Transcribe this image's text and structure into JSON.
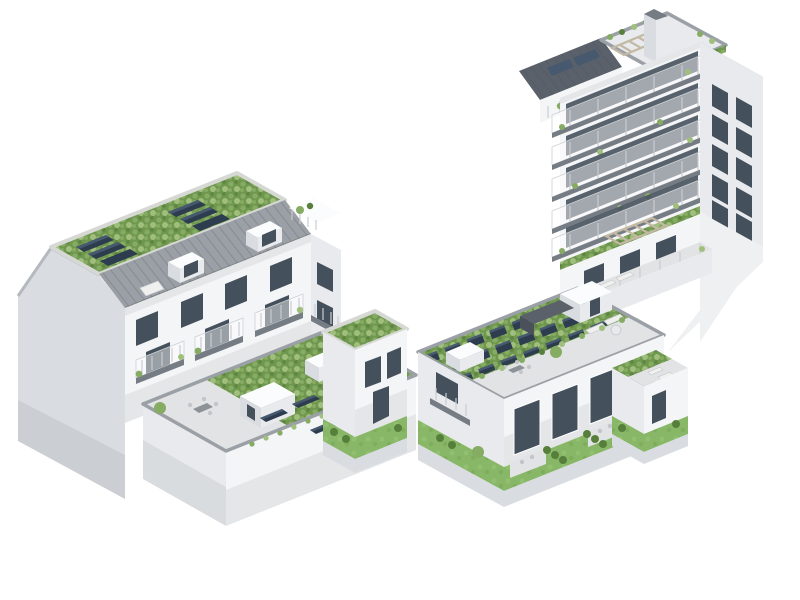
{
  "meta": {
    "kind": "architectural-3d-rendering",
    "view": "aerial axonometric",
    "background": "#ffffff"
  },
  "scene": {
    "description": "Aerial axonometric 3D rendering of a white residential perimeter-block development on a white background: a street building with grey standing-seam mansard roofs, rooftop solar panels and a green-roofed courtyard podium on the left, and a taller corner tower with stacked balconies, terraced setback wings, a large photovoltaic green roof, roof terraces and private gardens with hedges on the right.",
    "left_block": {
      "label": "street building with courtyard podium",
      "features": [
        "blank gable firewall",
        "standing-seam metal mansard roof",
        "roof skylight",
        "extensive green roof with tilted solar panels",
        "white dormer volumes",
        "balconies with plants and timber railings",
        "courtyard podium with green roof",
        "stair-head boxes",
        "roof terrace with dining set",
        "parapet cappings",
        "end wing with lawn and hedge"
      ]
    },
    "right_block": {
      "label": "corner tower with terraced wings and PV green roof",
      "features": [
        "roof chimney",
        "rooftop planters and greenery",
        "rooftop pergola",
        "dark slate mansard with solar skylights",
        "metal-clad attic storey",
        "five stacked balcony floors with glass railings",
        "window grid on side facade",
        "blank side firewall",
        "terraced setback flats with pergola",
        "roof terrace with loungers",
        "large green roof with photovoltaic array",
        "penthouse volume with mono-pitch roof",
        "stair-head boxes",
        "ground-floor gardens with lawns, patios, hedges and low garden walls"
      ]
    }
  },
  "palette": {
    "bg": "#ffffff",
    "facade": "#f4f5f7",
    "facade2": "#e8eaed",
    "facade3": "#d9dce0",
    "facade4": "#c7cbd0",
    "firewall": "#eef0f2",
    "metal": "#9aa0a6",
    "slate": "#5a616b",
    "slab": "#767c84",
    "window": "#44505b",
    "glass": "#4a5560",
    "green1": "#6f974e",
    "green2": "#86ab63",
    "green3": "#a0bf7d",
    "lawn": "#88b768",
    "hedge": "#567f3b",
    "gravel": "#d6d8d4",
    "terrace": "#e2e3e4",
    "wood": "#c3b9a4",
    "solar": "#2d3c4e",
    "solar2": "#46596f",
    "parapet": "#9aa0a5",
    "white": "#fbfcfd"
  }
}
